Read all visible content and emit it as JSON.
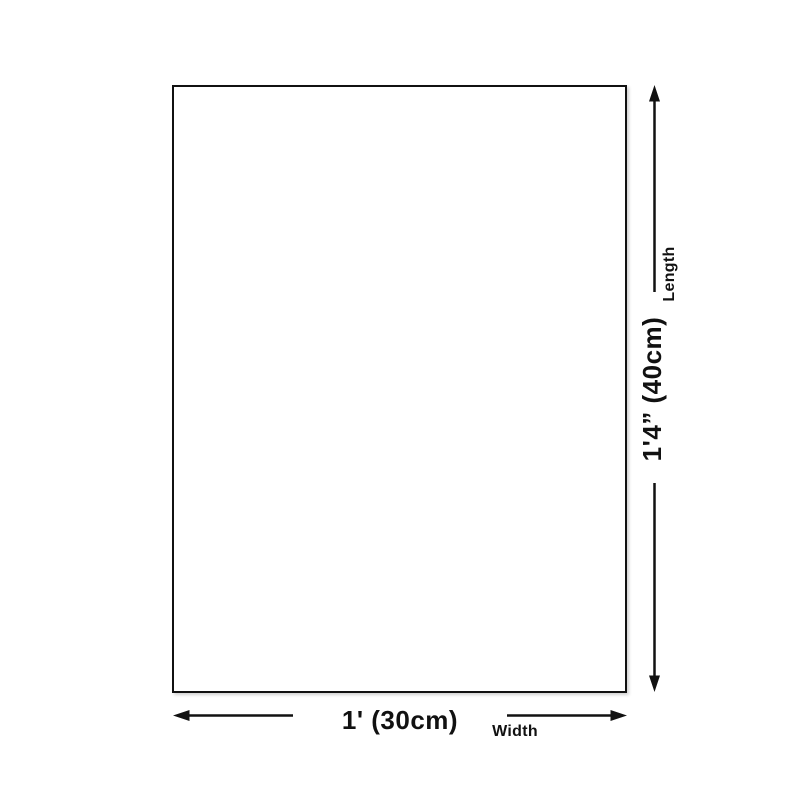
{
  "diagram": {
    "type": "product-dimension-diagram",
    "background_color": "#ffffff",
    "line_color": "#111111",
    "length": {
      "value": "1'4” (40cm)",
      "label": "Length"
    },
    "width": {
      "value": "1' (30cm)",
      "label": "Width"
    }
  }
}
